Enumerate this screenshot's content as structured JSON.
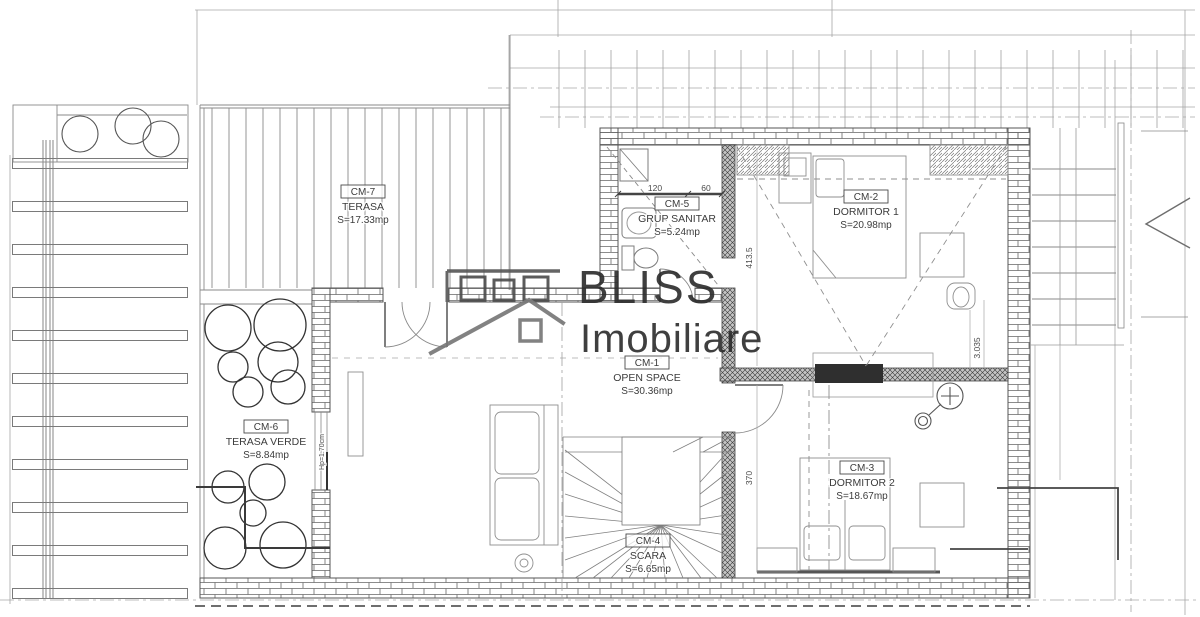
{
  "title": "Floor plan - mansarda",
  "watermark": {
    "brand": "BLISS",
    "sub": "Imobiliare",
    "logo_icon": "house-outline-icon"
  },
  "rooms": [
    {
      "code": "CM-1",
      "name": "OPEN SPACE",
      "area": "S=30.36mp"
    },
    {
      "code": "CM-2",
      "name": "DORMITOR 1",
      "area": "S=20.98mp"
    },
    {
      "code": "CM-3",
      "name": "DORMITOR 2",
      "area": "S=18.67mp"
    },
    {
      "code": "CM-4",
      "name": "SCARA",
      "area": "S=6.65mp"
    },
    {
      "code": "CM-5",
      "name": "GRUP SANITAR",
      "area": "S=5.24mp"
    },
    {
      "code": "CM-6",
      "name": "TERASA VERDE",
      "area": "S=8.84mp"
    },
    {
      "code": "CM-7",
      "name": "TERASA",
      "area": "S=17.33mp"
    }
  ],
  "dimensions": {
    "bath_left": "120",
    "bath_right": "60",
    "bedroom1_depth": "413.5",
    "wall_seg": "3.035",
    "bedroom2_depth": "370",
    "parapet": "Hp=1.70cm"
  }
}
